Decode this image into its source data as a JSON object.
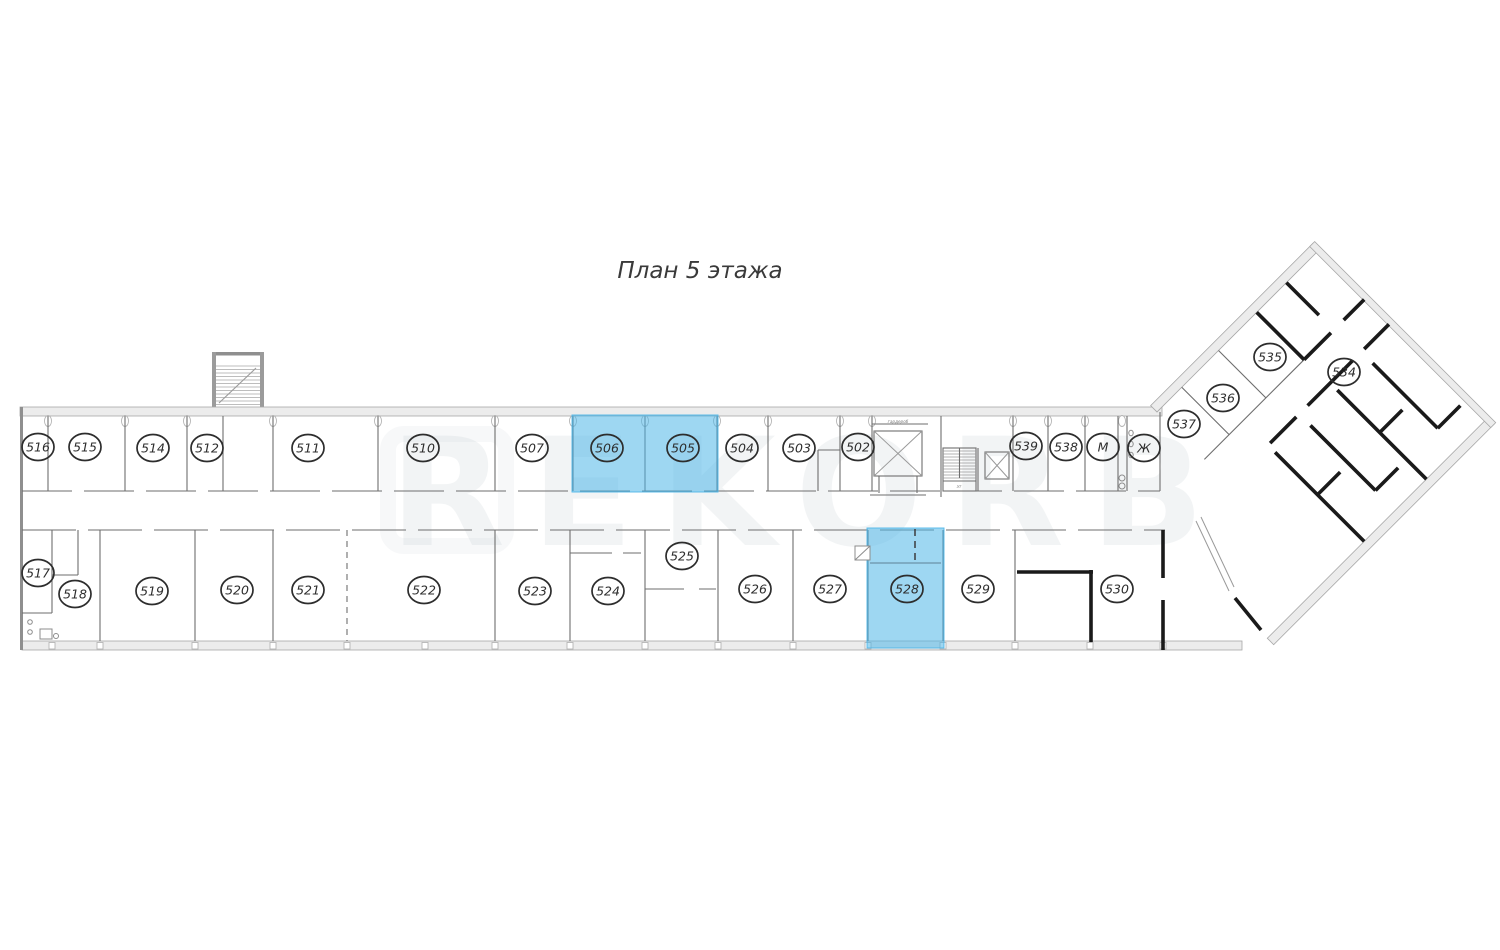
{
  "title": "План 5 этажа",
  "watermark": "REKORB",
  "small_labels": {
    "wardrobe": "гардероб",
    "stair_floor_mark": "эт"
  },
  "highlight_color": "#4fb6e8",
  "rooms": [
    {
      "label": "516",
      "x": 38,
      "y": 447
    },
    {
      "label": "515",
      "x": 85,
      "y": 447
    },
    {
      "label": "514",
      "x": 153,
      "y": 448
    },
    {
      "label": "512",
      "x": 207,
      "y": 448
    },
    {
      "label": "511",
      "x": 308,
      "y": 448
    },
    {
      "label": "510",
      "x": 423,
      "y": 448
    },
    {
      "label": "507",
      "x": 532,
      "y": 448
    },
    {
      "label": "506",
      "x": 607,
      "y": 448,
      "highlighted": true
    },
    {
      "label": "505",
      "x": 683,
      "y": 448,
      "highlighted": true
    },
    {
      "label": "504",
      "x": 742,
      "y": 448
    },
    {
      "label": "503",
      "x": 799,
      "y": 448
    },
    {
      "label": "502",
      "x": 858,
      "y": 447
    },
    {
      "label": "539",
      "x": 1026,
      "y": 446
    },
    {
      "label": "538",
      "x": 1066,
      "y": 447
    },
    {
      "label": "М",
      "x": 1103,
      "y": 447
    },
    {
      "label": "Ж",
      "x": 1144,
      "y": 448
    },
    {
      "label": "537",
      "x": 1184,
      "y": 424
    },
    {
      "label": "536",
      "x": 1223,
      "y": 398
    },
    {
      "label": "535",
      "x": 1270,
      "y": 357
    },
    {
      "label": "534",
      "x": 1344,
      "y": 372
    },
    {
      "label": "517",
      "x": 38,
      "y": 573
    },
    {
      "label": "518",
      "x": 75,
      "y": 594
    },
    {
      "label": "519",
      "x": 152,
      "y": 591
    },
    {
      "label": "520",
      "x": 237,
      "y": 590
    },
    {
      "label": "521",
      "x": 308,
      "y": 590
    },
    {
      "label": "522",
      "x": 424,
      "y": 590
    },
    {
      "label": "523",
      "x": 535,
      "y": 591
    },
    {
      "label": "524",
      "x": 608,
      "y": 591
    },
    {
      "label": "525",
      "x": 682,
      "y": 556
    },
    {
      "label": "526",
      "x": 755,
      "y": 589
    },
    {
      "label": "527",
      "x": 830,
      "y": 589
    },
    {
      "label": "528",
      "x": 907,
      "y": 589,
      "highlighted": true
    },
    {
      "label": "529",
      "x": 978,
      "y": 589
    },
    {
      "label": "530",
      "x": 1117,
      "y": 589
    }
  ],
  "highlights": [
    {
      "rooms": [
        "506",
        "505"
      ],
      "x": 572,
      "y": 415,
      "w": 146,
      "h": 77
    },
    {
      "rooms": [
        "528"
      ],
      "x": 867,
      "y": 528,
      "w": 77,
      "h": 120
    }
  ]
}
